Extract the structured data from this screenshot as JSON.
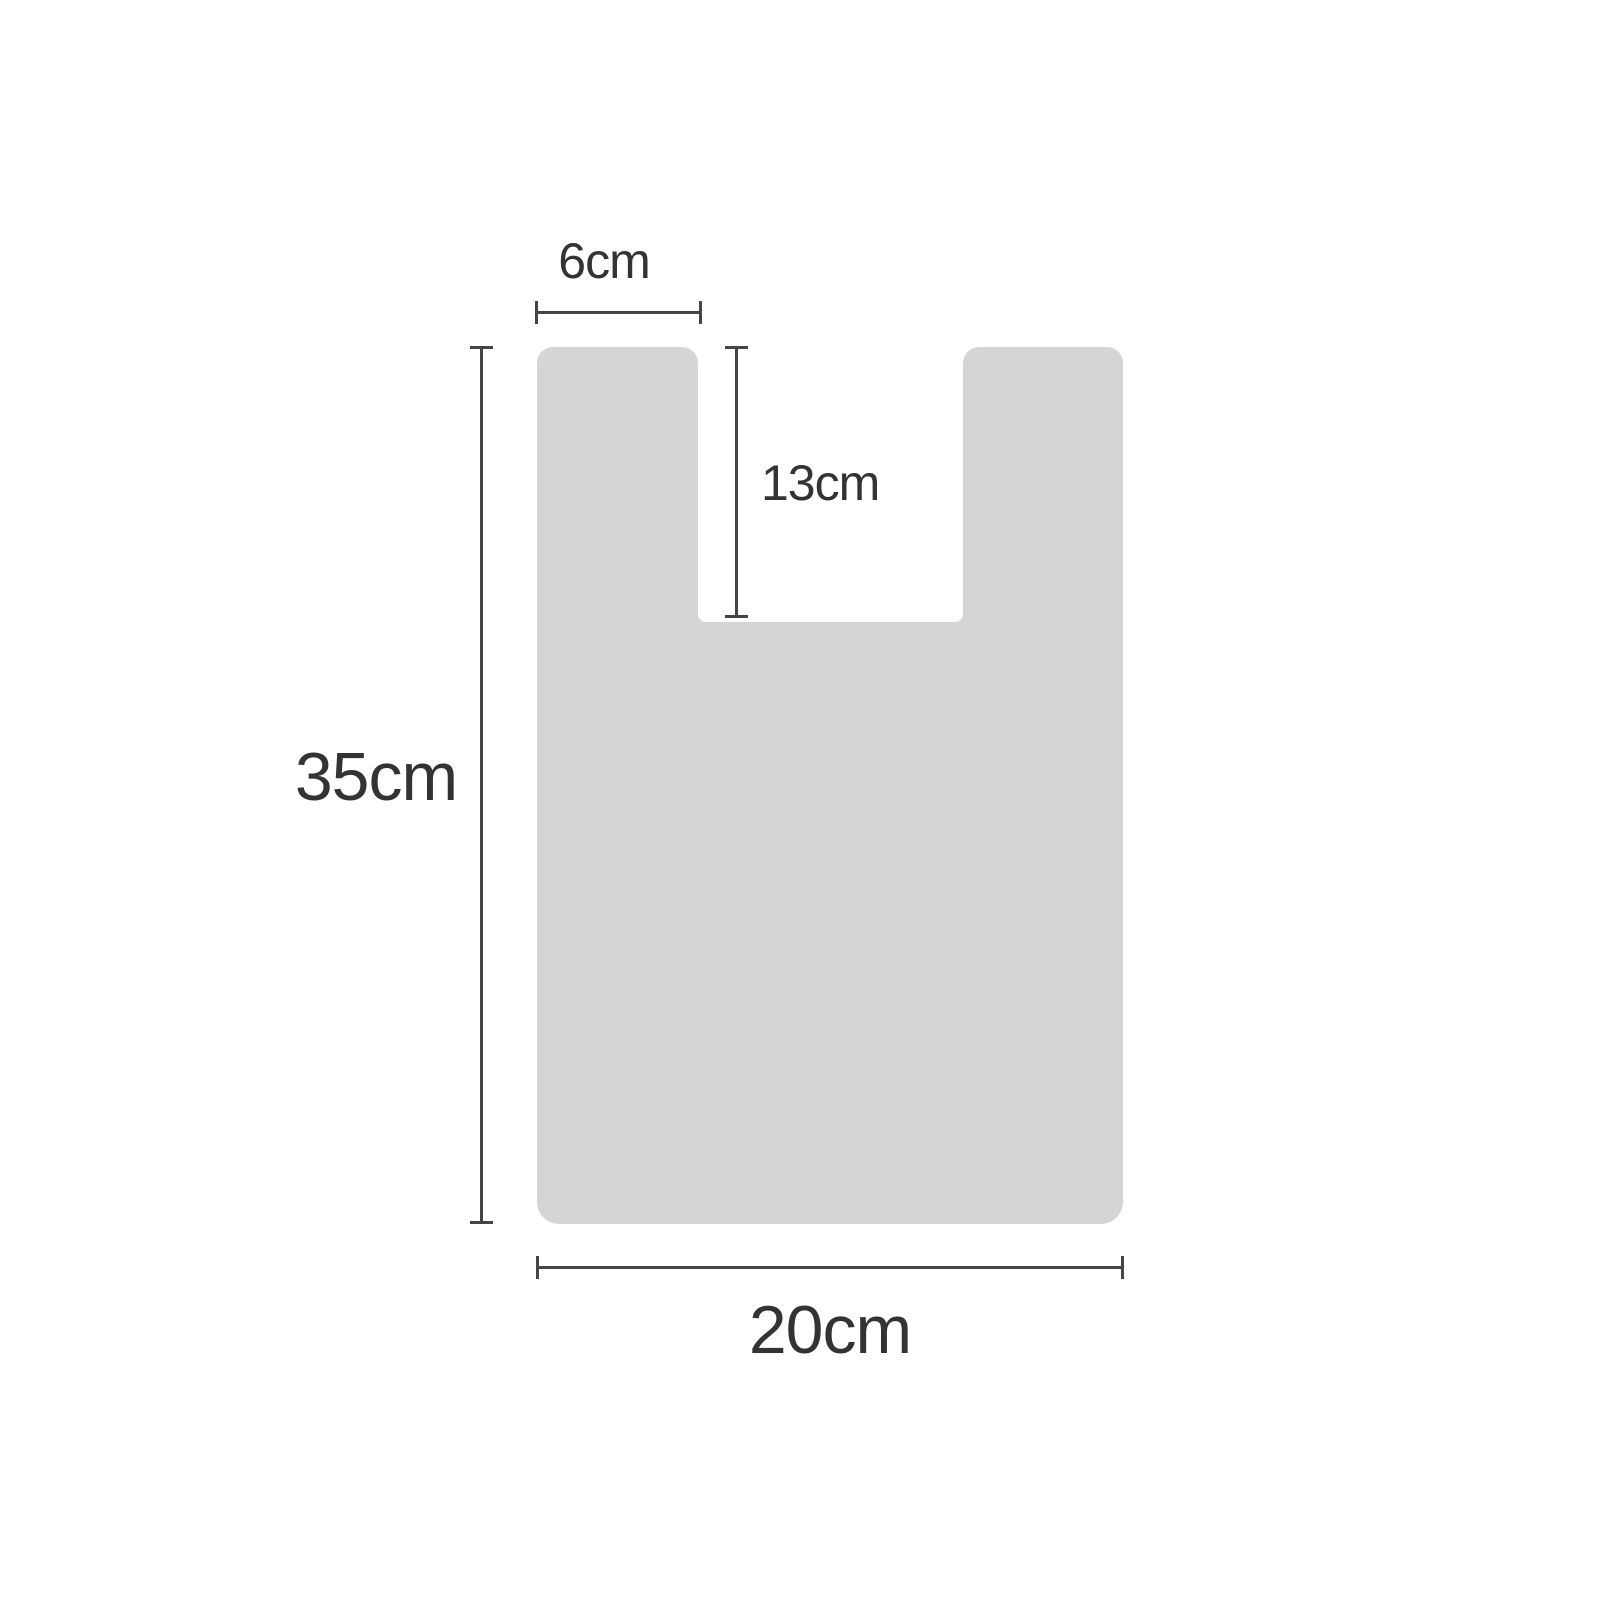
{
  "colors": {
    "background": "#ffffff",
    "shape_fill": "#d5d5d6",
    "dimension_line": "#454545",
    "label_text": "#333333"
  },
  "diagram": {
    "subject": "bag-silhouette-dimension-diagram",
    "dimensions": {
      "handle_width": {
        "label": "6cm"
      },
      "handle_notch_depth": {
        "label": "13cm"
      },
      "bag_height": {
        "label": "35cm"
      },
      "bag_width": {
        "label": "20cm"
      }
    }
  }
}
